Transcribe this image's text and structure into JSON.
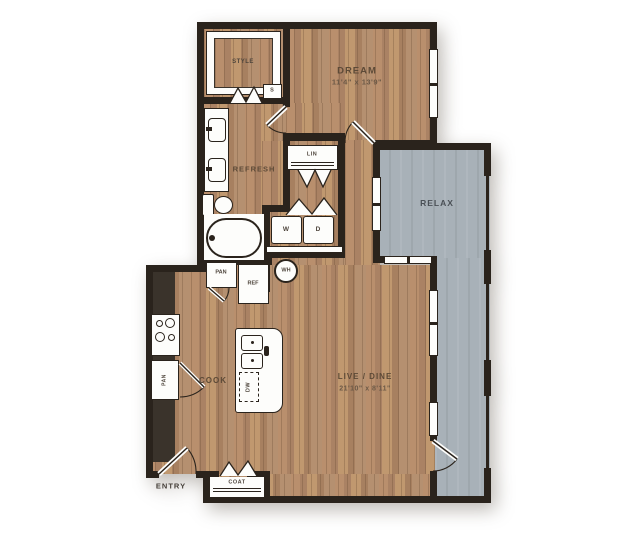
{
  "labels": {
    "bedroom": "DREAM",
    "bedroom_dims": "11'4\" x 13'9\"",
    "closet": "STYLE",
    "closet_shelf": "S",
    "bath": "REFRESH",
    "linen": "LIN",
    "washer": "W",
    "dryer": "D",
    "water_heater": "WH",
    "pantry": "PAN",
    "fridge": "REF",
    "kitchen": "COOK",
    "kitchen_pantry": "PAN",
    "dishwasher": "DW",
    "living": "LIVE / DINE",
    "living_dims": "21'10\" x 8'11\"",
    "balcony": "RELAX",
    "entry": "ENTRY",
    "coat": "COAT"
  },
  "colors": {
    "wall": "#2a231c",
    "wood_floor": "#b28d6e",
    "balcony_floor": "#a8b1b8",
    "fixture_white": "#fdfdfb",
    "counter_dark": "#3a332b",
    "label_brown": "#5d4a37",
    "label_gray": "#4a5056"
  }
}
